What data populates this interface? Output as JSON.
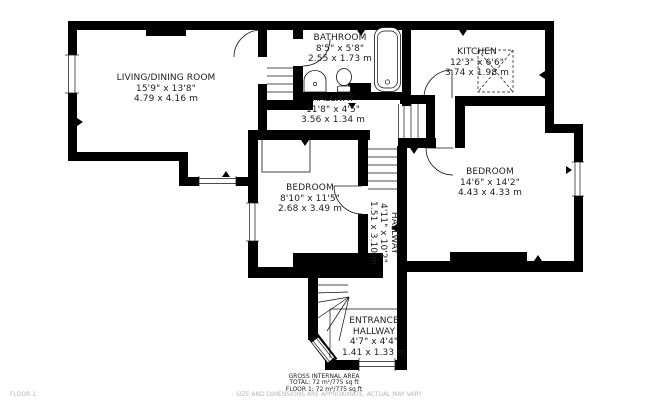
{
  "plan": {
    "rooms": [
      {
        "name": "LIVING/DINING ROOM",
        "imperial": "15'9\" x 13'8\"",
        "metric": "4.79 x 4.16 m"
      },
      {
        "name": "BATHROOM",
        "imperial": "8'5\" x 5'8\"",
        "metric": "2.55 x 1.73 m"
      },
      {
        "name": "KITCHEN",
        "imperial": "12'3\" x 6'6\"",
        "metric": "3.74 x 1.98 m"
      },
      {
        "name": "HALLWAY",
        "imperial": "11'8\" x 4'5\"",
        "metric": "3.56 x 1.34 m"
      },
      {
        "name": "BEDROOM",
        "imperial": "8'10\" x 11'5\"",
        "metric": "2.68 x 3.49 m"
      },
      {
        "name": "BEDROOM",
        "imperial": "14'6\" x 14'2\"",
        "metric": "4.43 x 4.33 m"
      },
      {
        "name": "HALLWAY",
        "imperial": "4'11\" x 10'2\"",
        "metric": "1.51 x 3.10 m"
      },
      {
        "name": "ENTRANCE HALLWAY",
        "imperial": "4'7\" x 4'4\"",
        "metric": "1.41 x 1.33 m"
      }
    ],
    "footer": {
      "title": "GROSS INTERNAL AREA",
      "total": "TOTAL: 72 m²/775 sq ft",
      "floor1": "FLOOR 1: 72 m²/775 sq ft",
      "disclaimer": "SIZE AND DIMENSIONS ARE APPROXIMATE, ACTUAL MAY VARY",
      "floor_label": "FLOOR 1"
    },
    "colors": {
      "wall": "#000000",
      "line": "#111111",
      "text": "#1d1d1d",
      "muted": "#b5b5b5",
      "bg": "#ffffff"
    }
  }
}
